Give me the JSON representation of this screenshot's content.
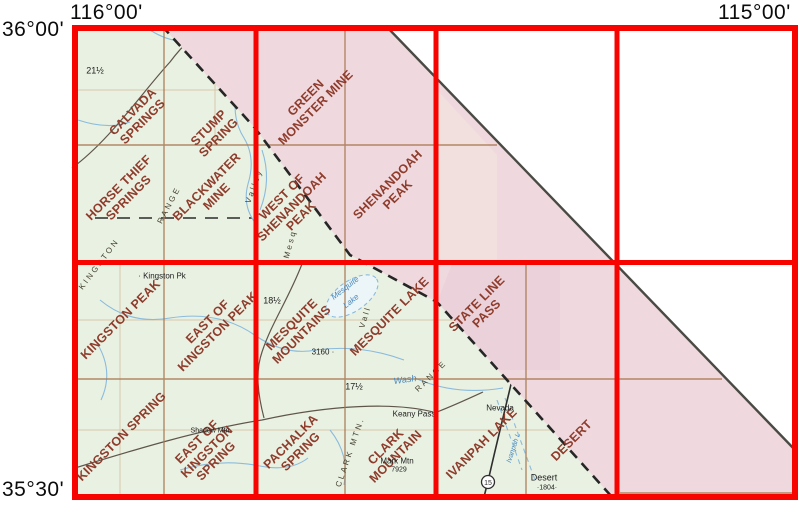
{
  "title": "Quadrangle index map 116°00'–115°00' / 36°00'–35°30'",
  "coordinates": {
    "top_left": "116°00'",
    "top_right": "115°00'",
    "left_top": "36°00'",
    "left_bottom": "35°30'"
  },
  "colors": {
    "grid_red": "#f80400",
    "map_green": "#e9f1e2",
    "band_pink": "#f0d9de",
    "quad_label": "#8e3c2c",
    "water_blue": "#7fb2d8",
    "contour_brown": "#a87850"
  },
  "quads": [
    {
      "name": "calvada-springs",
      "lines": [
        "CALVADA",
        "SPRINGS"
      ]
    },
    {
      "name": "stump-spring",
      "lines": [
        "STUMP",
        "SPRING"
      ]
    },
    {
      "name": "green-monster-mine",
      "lines": [
        "GREEN",
        "MONSTER MINE"
      ]
    },
    {
      "name": "horse-thief-springs",
      "lines": [
        "HORSE THIEF",
        "SPRINGS"
      ]
    },
    {
      "name": "blackwater-mine",
      "lines": [
        "BLACKWATER",
        "MINE"
      ]
    },
    {
      "name": "west-of-shenandoah-peak",
      "lines": [
        "WEST OF",
        "SHENANDOAH",
        "PEAK"
      ]
    },
    {
      "name": "shenandoah-peak",
      "lines": [
        "SHENANDOAH",
        "PEAK"
      ]
    },
    {
      "name": "kingston-peak",
      "lines": [
        "KINGSTON PEAK"
      ]
    },
    {
      "name": "east-of-kingston-peak",
      "lines": [
        "EAST OF",
        "KINGSTON PEAK"
      ]
    },
    {
      "name": "mesquite-mountains",
      "lines": [
        "MESQUITE",
        "MOUNTAINS"
      ]
    },
    {
      "name": "mesquite-lake",
      "lines": [
        "MESQUITE LAKE"
      ]
    },
    {
      "name": "state-line-pass",
      "lines": [
        "STATE LINE",
        "PASS"
      ]
    },
    {
      "name": "kingston-spring",
      "lines": [
        "KINGSTON SPRING"
      ]
    },
    {
      "name": "east-of-kingston-spring",
      "lines": [
        "EAST OF",
        "KINGSTON",
        "SPRING"
      ]
    },
    {
      "name": "pachalka-spring",
      "lines": [
        "PACHALKA",
        "SPRING"
      ]
    },
    {
      "name": "clark-mountain",
      "lines": [
        "CLARK",
        "MOUNTAIN"
      ]
    },
    {
      "name": "ivanpah-lake",
      "lines": [
        "IVANPAH LAKE"
      ]
    },
    {
      "name": "desert",
      "lines": [
        "DESERT"
      ]
    }
  ],
  "map_texts": [
    {
      "text": "21½"
    },
    {
      "text": "· Kingston Pk"
    },
    {
      "text": "18½"
    },
    {
      "text": "3160 ·"
    },
    {
      "text": "17½"
    },
    {
      "text": "Keany Pass"
    },
    {
      "text": "Mark Mtn"
    },
    {
      "text": "7929"
    },
    {
      "text": "Desert"
    },
    {
      "text": "·1804·"
    },
    {
      "text": "Nevada"
    },
    {
      "text": "Shadow Mtn"
    },
    {
      "text": "Wash"
    },
    {
      "text": "Mesquite"
    },
    {
      "text": "Lake"
    },
    {
      "text": "Ivanpah L"
    },
    {
      "text": "Valley"
    },
    {
      "text": "RANGE"
    },
    {
      "text": "KINGSTON"
    },
    {
      "text": "Vall"
    },
    {
      "text": "RANGE"
    },
    {
      "text": "CLARK MTN."
    },
    {
      "text": "Mesq"
    }
  ],
  "shield_number": "15"
}
